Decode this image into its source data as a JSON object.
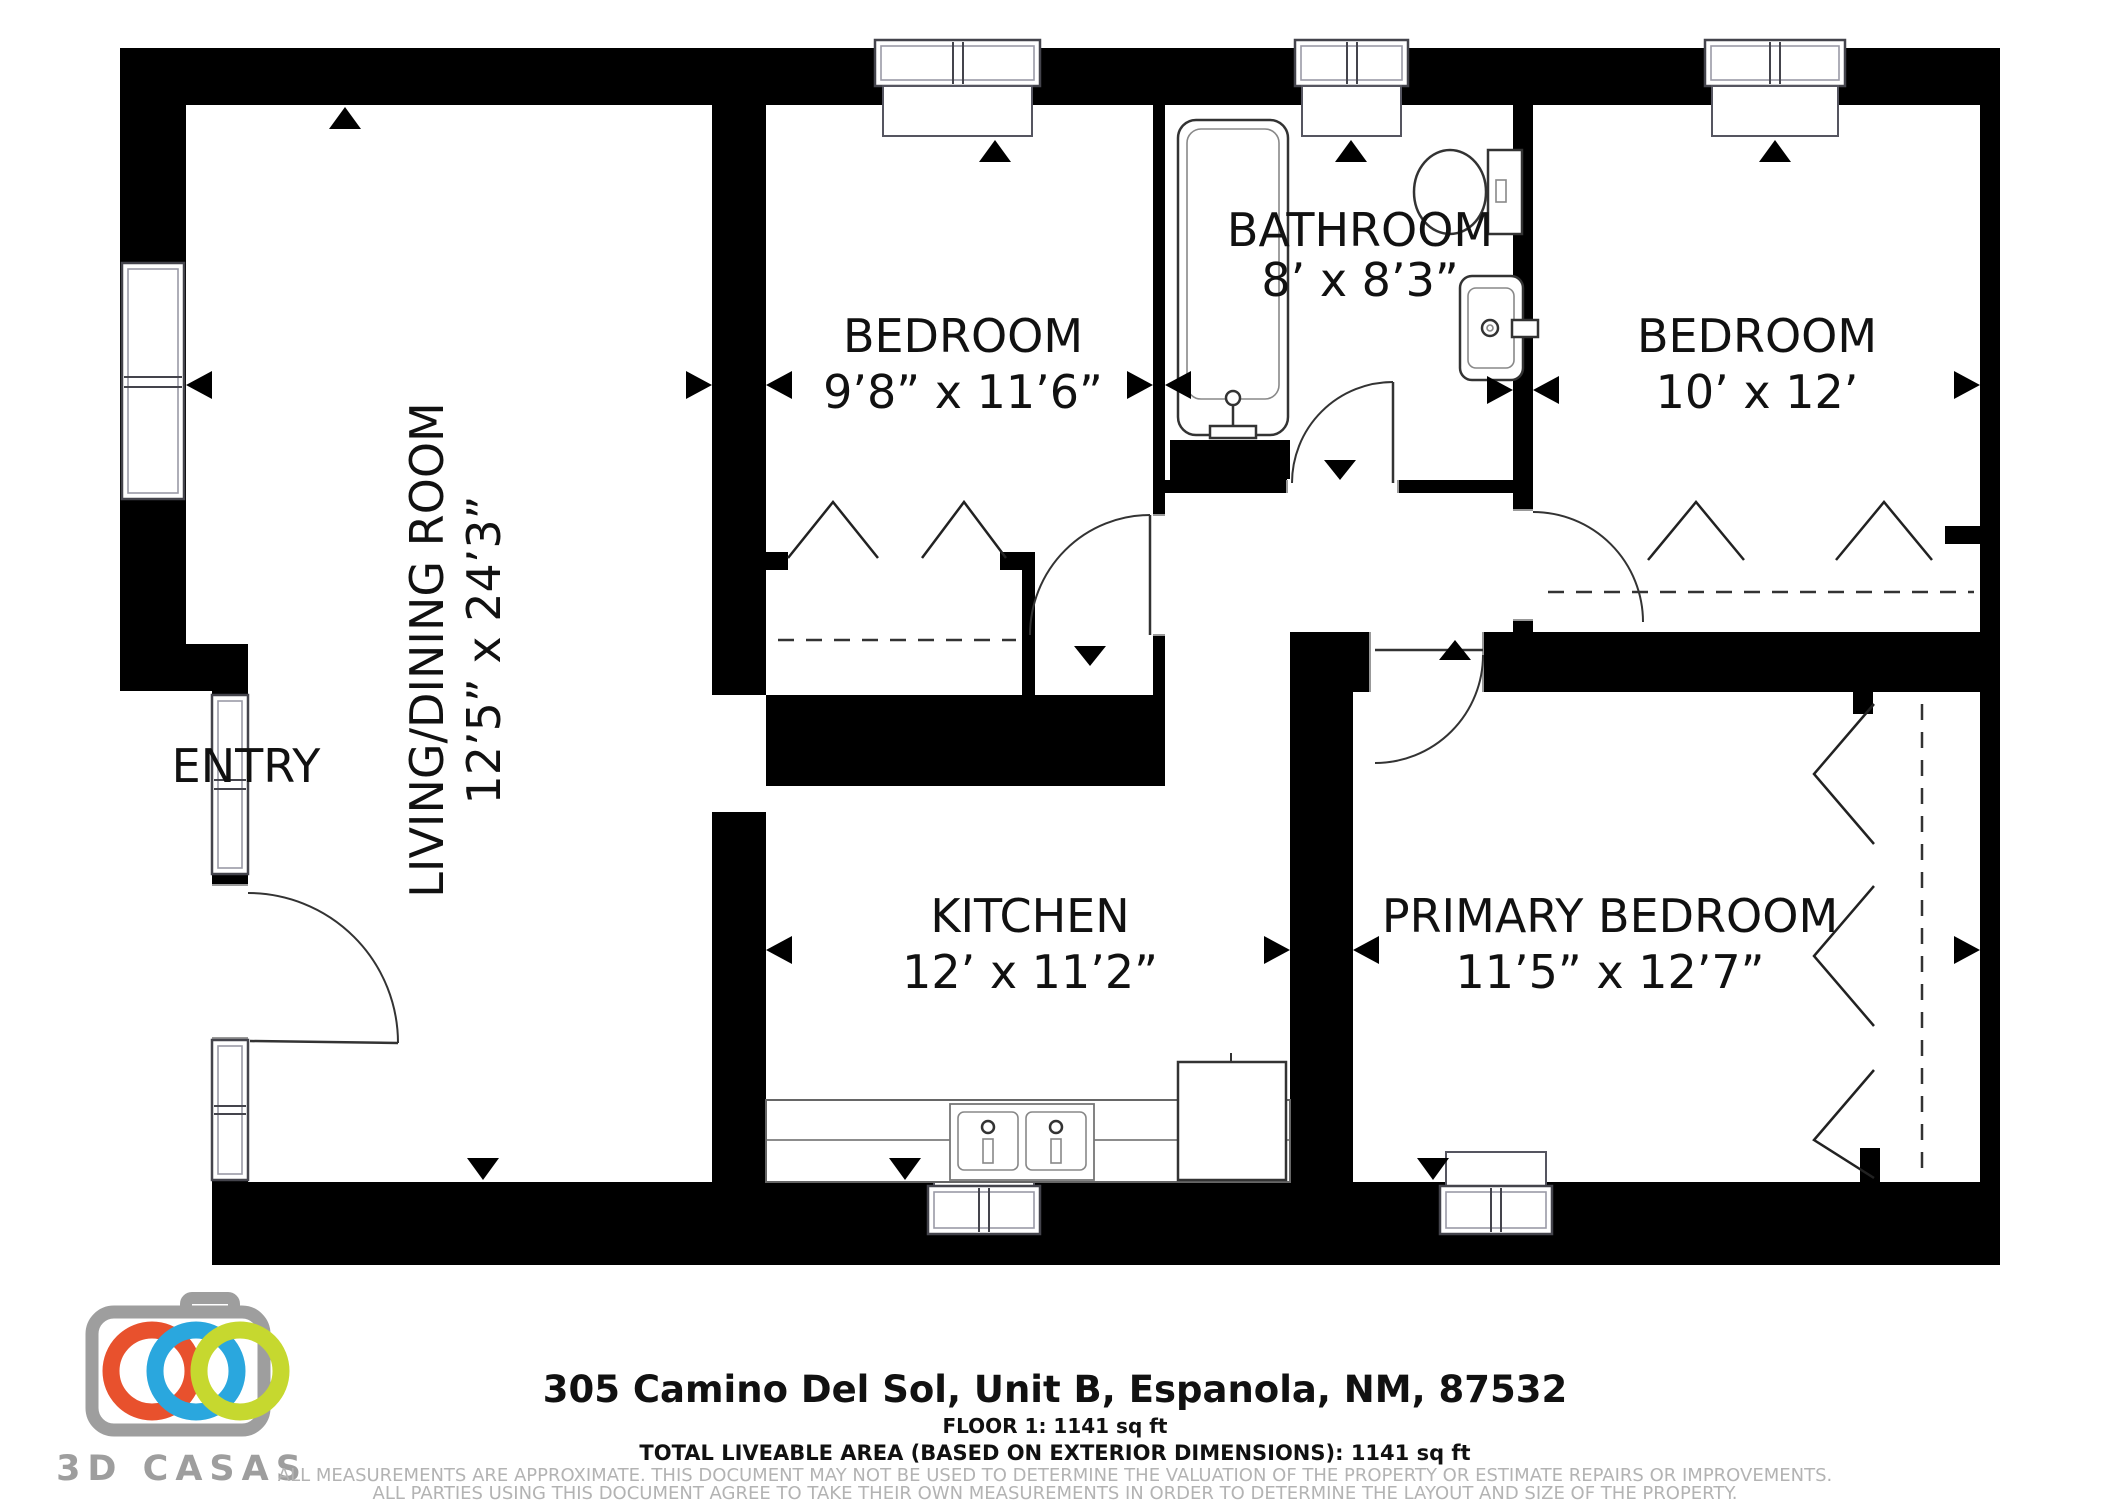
{
  "document_type": "floor-plan",
  "colors": {
    "wall": "#000000",
    "line": "#333333",
    "disclaimer_gray": "#b3b3b3",
    "logo_gray": "#9e9e9e",
    "ring_orange": "#e8512d",
    "ring_blue": "#2aa7de",
    "ring_green": "#c6d82f"
  },
  "rooms": {
    "living": {
      "name": "LIVING/DINING ROOM",
      "dims": "12’5” x 24’3”"
    },
    "bedroom1": {
      "name": "BEDROOM",
      "dims": "9’8” x 11’6”"
    },
    "bathroom": {
      "name": "BATHROOM",
      "dims": "8’ x 8’3”"
    },
    "bedroom2": {
      "name": "BEDROOM",
      "dims": "10’ x 12’"
    },
    "kitchen": {
      "name": "KITCHEN",
      "dims": "12’ x 11’2”"
    },
    "primary": {
      "name": "PRIMARY BEDROOM",
      "dims": "11’5” x 12’7”"
    },
    "entry": {
      "name": "ENTRY"
    }
  },
  "footer": {
    "address": "305 Camino Del Sol, Unit B, Espanola, NM, 87532",
    "floor": "FLOOR 1: 1141 sq ft",
    "total": "TOTAL LIVEABLE AREA (BASED ON EXTERIOR DIMENSIONS): 1141 sq ft",
    "disclaimer1": "ALL MEASUREMENTS ARE APPROXIMATE. THIS DOCUMENT MAY NOT BE USED TO DETERMINE THE VALUATION OF THE PROPERTY OR ESTIMATE REPAIRS OR IMPROVEMENTS.",
    "disclaimer2": "ALL PARTIES USING THIS DOCUMENT AGREE TO TAKE THEIR OWN MEASUREMENTS IN ORDER TO DETERMINE THE LAYOUT AND SIZE OF THE PROPERTY."
  },
  "logo": {
    "brand": "3D CASAS"
  }
}
